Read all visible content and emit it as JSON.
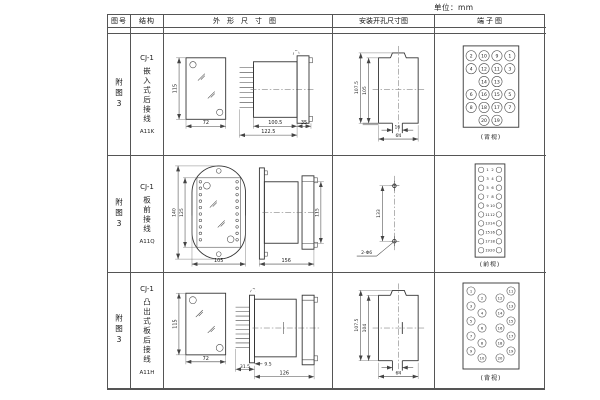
{
  "unit_label": "单位：mm",
  "table": {
    "headers": {
      "figure_no": "图号",
      "structure": "结构",
      "outline": "外形尺寸图",
      "install": "安装开孔尺寸图",
      "terminal": "端子图"
    },
    "rows": [
      {
        "figure_no": "附图3",
        "model": "CJ-1",
        "structure_desc": "嵌入式后接线",
        "code": "A11K",
        "outline_dims": {
          "front_height": "115",
          "front_width": "72",
          "body_length": "100.5",
          "total_length": "122.5",
          "flange_depth": "35"
        },
        "install_dims": {
          "cutout_outer_height": "107.5",
          "cutout_height": "105",
          "slot_width": "16",
          "cutout_width": "64"
        },
        "terminal_view_label": "(背视)",
        "terminal_rows": [
          [
            "2",
            "10",
            "9",
            "1"
          ],
          [
            "4",
            "12",
            "11",
            "3"
          ],
          [
            "14",
            "13"
          ],
          [
            "6",
            "16",
            "15",
            "5"
          ],
          [
            "8",
            "18",
            "17",
            "7"
          ],
          [
            "20",
            "19"
          ]
        ]
      },
      {
        "figure_no": "附图3",
        "model": "CJ-1",
        "structure_desc": "板前接线",
        "code": "A11Q",
        "outline_dims": {
          "front_outer_height": "140",
          "front_inner_height": "125",
          "front_width": "105",
          "total_length": "156",
          "body_height": "115"
        },
        "install_dims": {
          "hole_spacing": "133",
          "hole_note": "2-Φ6"
        },
        "terminal_view_label": "(前视)",
        "terminal_left_col": [
          "1",
          "3",
          "5",
          "7",
          "9",
          "11",
          "13",
          "15",
          "17",
          "19"
        ],
        "terminal_right_col": [
          "2",
          "4",
          "6",
          "8",
          "10",
          "12",
          "14",
          "16",
          "18",
          "20"
        ]
      },
      {
        "figure_no": "附图3",
        "model": "CJ-1",
        "structure_desc": "凸出式板后接线",
        "code": "A11H",
        "outline_dims": {
          "front_height": "115",
          "front_width": "72",
          "pin_length": "31.5",
          "plate_offset": "9.5",
          "total_length": "126"
        },
        "install_dims": {
          "cutout_outer_height": "107.5",
          "cutout_height": "104",
          "cutout_width": "64"
        },
        "terminal_view_label": "(背视)",
        "terminal_cols": [
          [
            "1",
            "3",
            "5",
            "7",
            "9"
          ],
          [
            "2",
            "4",
            "6",
            "8",
            "10"
          ],
          [
            "12",
            "14",
            "16",
            "18",
            "20"
          ],
          [
            "11",
            "13",
            "15",
            "17",
            "19"
          ]
        ]
      }
    ]
  }
}
